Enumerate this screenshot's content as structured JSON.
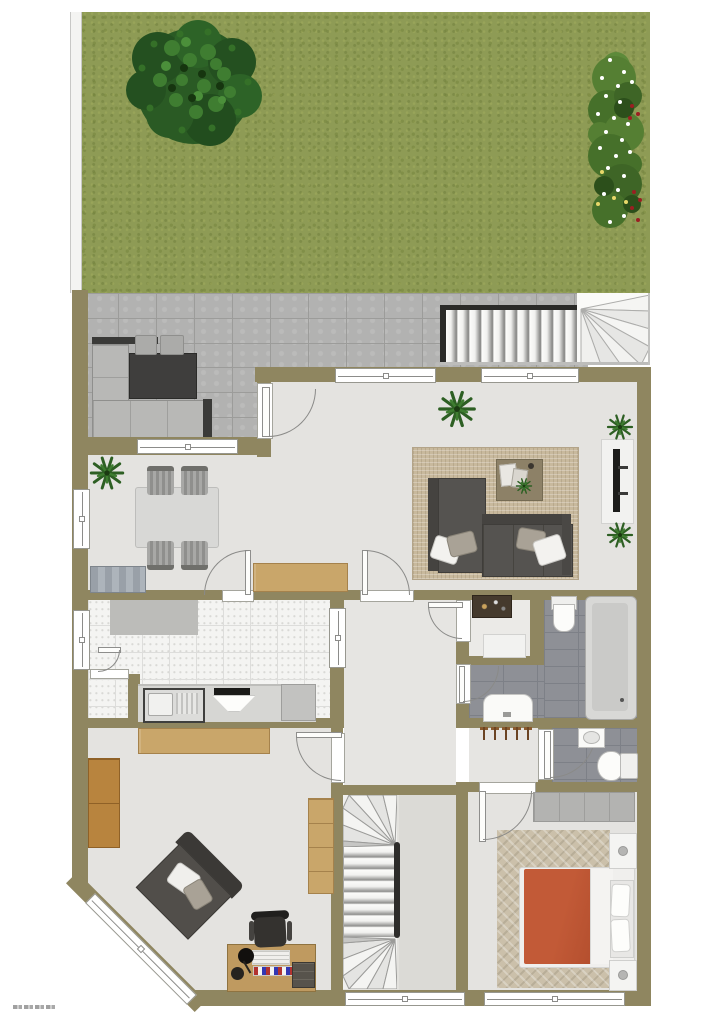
{
  "meta": {
    "type": "architectural-floor-plan",
    "view": "top-down 2D rendered plan",
    "scene": "ground floor apartment with garden, paved terrace, exterior stair and interior winder staircase",
    "watermark": {
      "position": "bottom-left",
      "legible": false
    }
  },
  "palette": {
    "wall": "#8f8660",
    "floor": "#e4e3e0",
    "hall_floor": "#e6e5e2",
    "grass": "#8e9b55",
    "paver": "#b2b2b1",
    "kitchen_tile": "#f4f4f2",
    "bath_tile": "#8e9096",
    "rug_living": "#c8b99d",
    "rug_bedroom": "#cbc0aa",
    "sofa_dark": "#555350",
    "outdoor_cushion": "#b8b8b6",
    "wood": "#c9a66a",
    "wood_dark": "#b8843e",
    "bed_duvet": "#c05a36",
    "stair_tread": "#f4f4f2",
    "frame_dark": "#2a2a28"
  },
  "inventory": {
    "rooms": [
      "garden",
      "terrace",
      "living-dining",
      "kitchen",
      "pantry",
      "hallway",
      "utility-room",
      "bathroom",
      "wc",
      "bedroom",
      "office",
      "stair-room"
    ],
    "windows": 9,
    "doors": 9,
    "plants": 5,
    "tree": 1,
    "flower_bed": 1,
    "coat_hooks": 5,
    "furniture": [
      "outdoor-l-sofa",
      "outdoor-coffee-table",
      "outdoor-stools",
      "dining-table",
      "dining-chairs",
      "gray-sideboard",
      "wood-sideboard",
      "living-l-sofa",
      "coffee-table",
      "tv-panel",
      "kitchen-counter",
      "kitchen-sink",
      "cooktop-with-hood",
      "kitchen-appliance",
      "bathtub",
      "toilet",
      "vanity-sink",
      "wc-basin",
      "wc-toilet-with-cistern",
      "bedroom-wardrobe",
      "double-bed",
      "nightstands",
      "desk",
      "office-chair",
      "armchair",
      "bookshelf",
      "stairs-exterior",
      "stairs-interior"
    ]
  }
}
